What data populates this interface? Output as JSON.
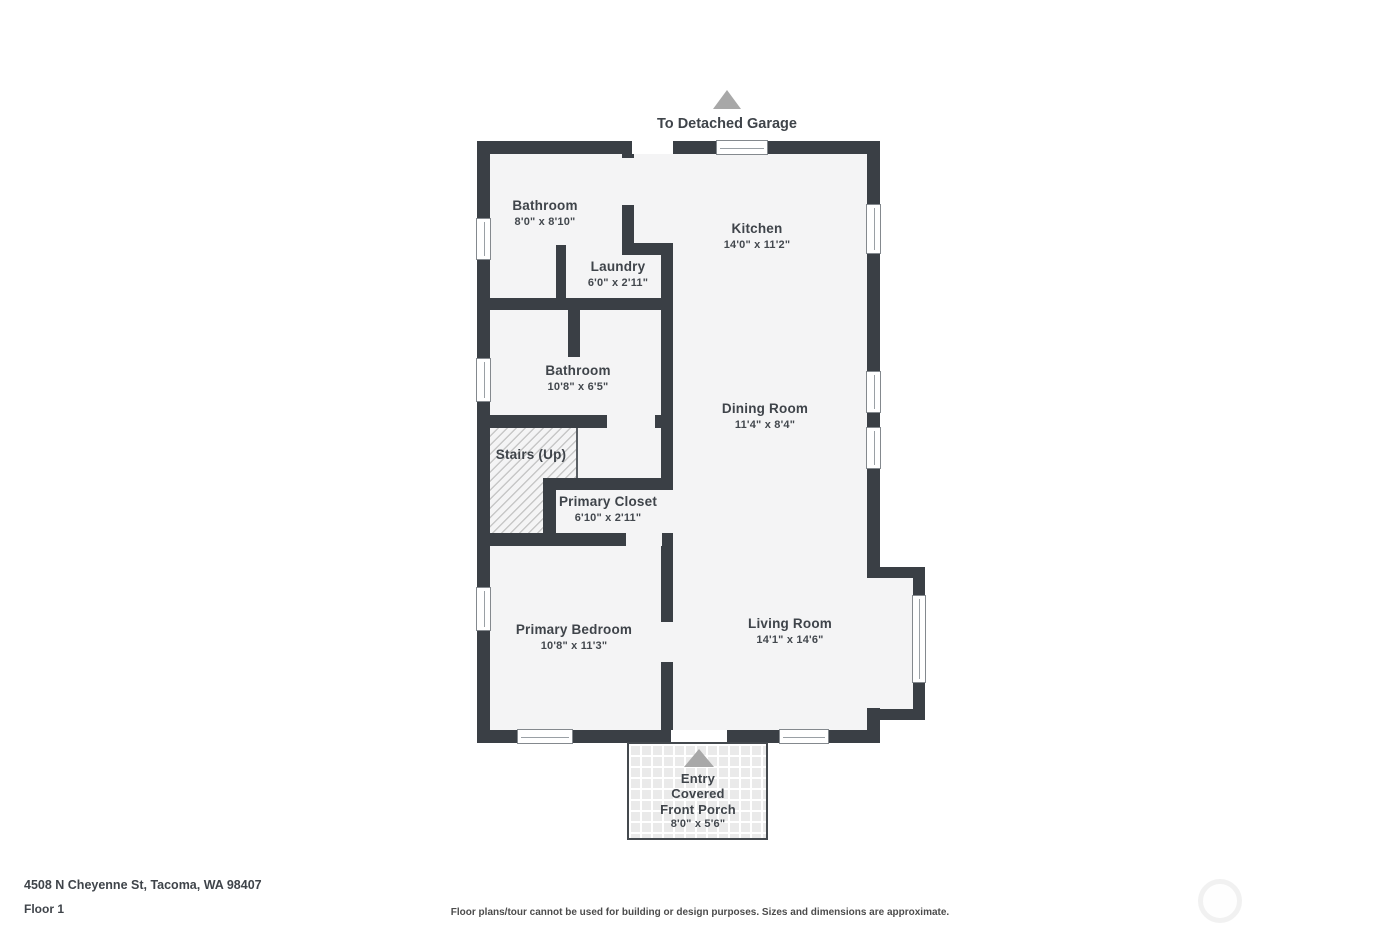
{
  "annotations": {
    "garage_label": "To Detached Garage"
  },
  "rooms": {
    "bathroom_upper": {
      "name": "Bathroom",
      "dims": "8'0\" x 8'10\""
    },
    "kitchen": {
      "name": "Kitchen",
      "dims": "14'0\" x 11'2\""
    },
    "laundry": {
      "name": "Laundry",
      "dims": "6'0\" x 2'11\""
    },
    "bathroom_lower": {
      "name": "Bathroom",
      "dims": "10'8\" x 6'5\""
    },
    "dining_room": {
      "name": "Dining Room",
      "dims": "11'4\" x 8'4\""
    },
    "stairs": {
      "name": "Stairs (Up)"
    },
    "primary_closet": {
      "name": "Primary Closet",
      "dims": "6'10\" x 2'11\""
    },
    "primary_bedroom": {
      "name": "Primary Bedroom",
      "dims": "10'8\" x 11'3\""
    },
    "living_room": {
      "name": "Living Room",
      "dims": "14'1\" x 14'6\""
    },
    "porch": {
      "line1": "Entry",
      "line2": "Covered",
      "line3": "Front Porch",
      "dims": "8'0\" x 5'6\""
    }
  },
  "footer": {
    "address": "4508 N Cheyenne St, Tacoma, WA 98407",
    "floor": "Floor 1",
    "disclaimer": "Floor plans/tour cannot be used for building or design purposes. Sizes and dimensions are approximate."
  },
  "colors": {
    "wall": "#3a3f45",
    "floor_fill": "#f4f4f5",
    "label_text": "#3f444a",
    "arrow": "#a8a8a8",
    "hatch_line": "#c7c7c7",
    "porch_tile": "#eaeaea"
  }
}
